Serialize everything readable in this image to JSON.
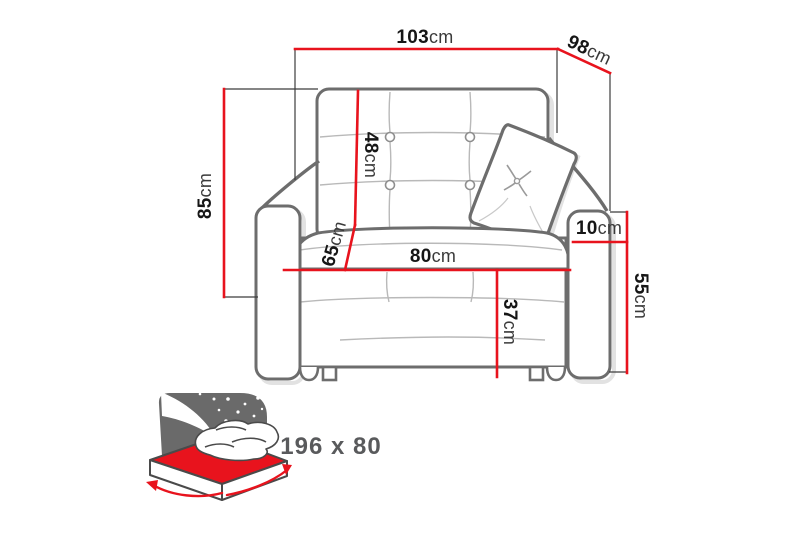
{
  "labels": {
    "total_width": {
      "value": "103",
      "unit": "cm"
    },
    "depth": {
      "value": "98",
      "unit": "cm"
    },
    "total_height": {
      "value": "85",
      "unit": "cm"
    },
    "backrest_height": {
      "value": "48",
      "unit": "cm"
    },
    "seat_depth": {
      "value": "65",
      "unit": "cm"
    },
    "seat_width": {
      "value": "80",
      "unit": "cm"
    },
    "armrest_width": {
      "value": "10",
      "unit": "cm"
    },
    "armrest_height": {
      "value": "55",
      "unit": "cm"
    },
    "seat_height": {
      "value": "37",
      "unit": "cm"
    }
  },
  "bed": {
    "size_label": "196 x 80",
    "icon": "sofa-bed-sleeping-area-icon"
  },
  "colors": {
    "dimension_red": "#e8131d",
    "outline_gray": "#6d6d6d",
    "seam_gray": "#b9b9b9",
    "extension_black": "#3c3c3c",
    "text_black": "#161616",
    "bed_text_gray": "#595a5c",
    "icon_board_gray": "#6a6a6a",
    "background": "#ffffff"
  }
}
